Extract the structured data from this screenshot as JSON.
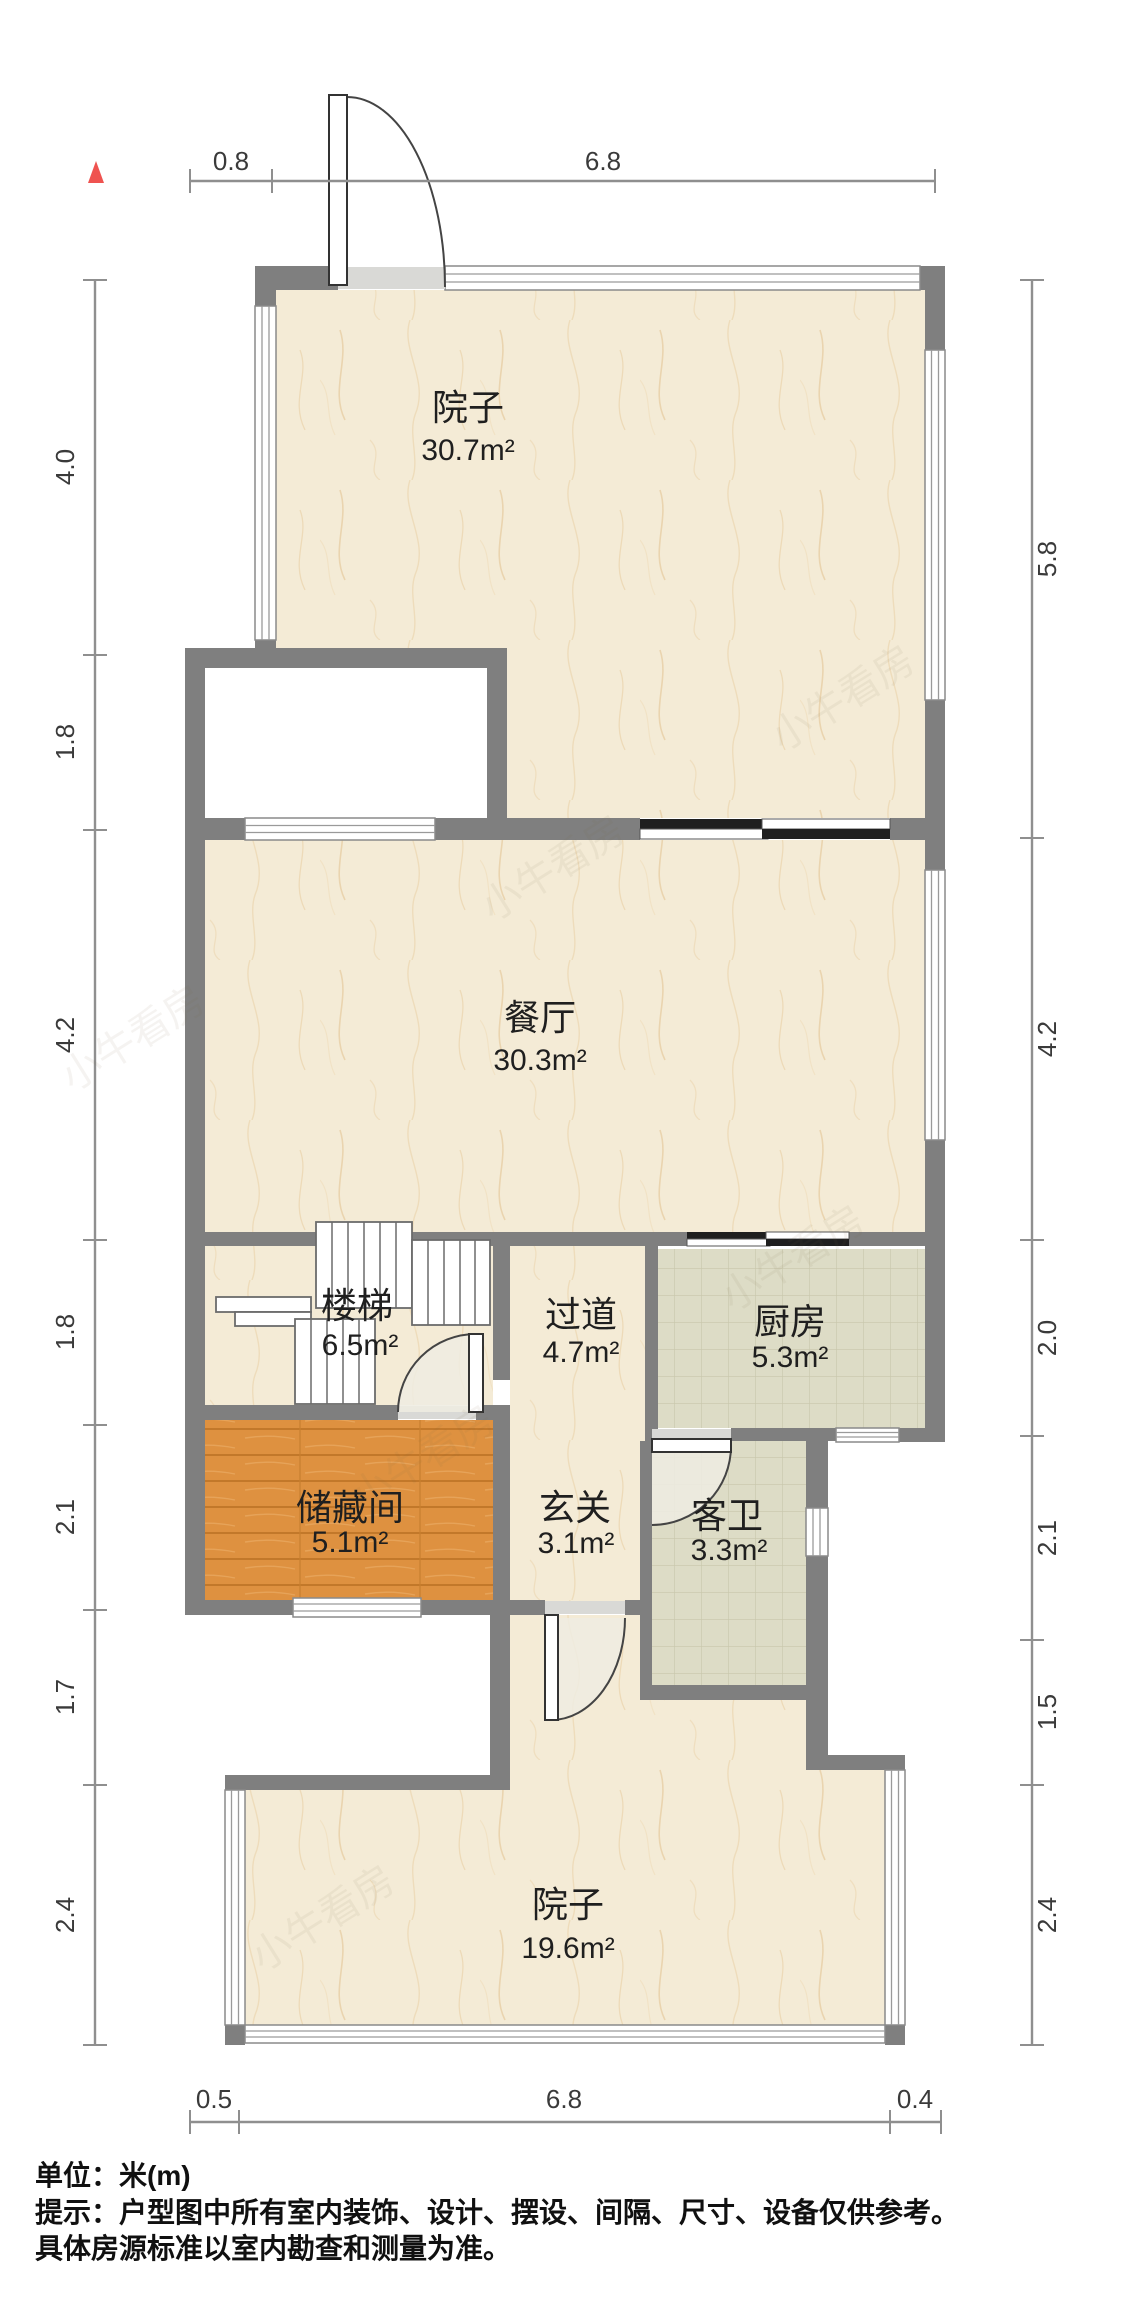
{
  "rooms": {
    "yard_top": {
      "name": "院子",
      "area": "30.7m²"
    },
    "dining": {
      "name": "餐厅",
      "area": "30.3m²"
    },
    "stairs": {
      "name": "楼梯",
      "area": "6.5m²"
    },
    "hallway": {
      "name": "过道",
      "area": "4.7m²"
    },
    "kitchen": {
      "name": "厨房",
      "area": "5.3m²"
    },
    "storage": {
      "name": "储藏间",
      "area": "5.1m²"
    },
    "entry": {
      "name": "玄关",
      "area": "3.1m²"
    },
    "guest_bath": {
      "name": "客卫",
      "area": "3.3m²"
    },
    "yard_bottom": {
      "name": "院子",
      "area": "19.6m²"
    }
  },
  "dimensions": {
    "top": [
      "0.8",
      "6.8"
    ],
    "bottom": [
      "0.5",
      "6.8",
      "0.4"
    ],
    "left": [
      "4.0",
      "1.8",
      "4.2",
      "1.8",
      "2.1",
      "1.7",
      "2.4"
    ],
    "right": [
      "5.8",
      "4.2",
      "2.0",
      "2.1",
      "1.5",
      "2.4"
    ]
  },
  "footer": {
    "line1": "单位：米(m)",
    "line2": "提示：户型图中所有室内装饰、设计、摆设、间隔、尺寸、设备仅供参考。",
    "line3": "具体房源标准以室内勘查和测量为准。"
  },
  "watermark": {
    "text": "小牛看房"
  },
  "north_arrow": {
    "color": "#ef5350"
  },
  "colors": {
    "wall": "#7f7f7f",
    "floor_marble": "#f4ebd6",
    "floor_tile": "#dddcc6",
    "floor_wood": "#de9140",
    "dim_text": "#3a3a3a",
    "door_sector": "#efece2"
  }
}
